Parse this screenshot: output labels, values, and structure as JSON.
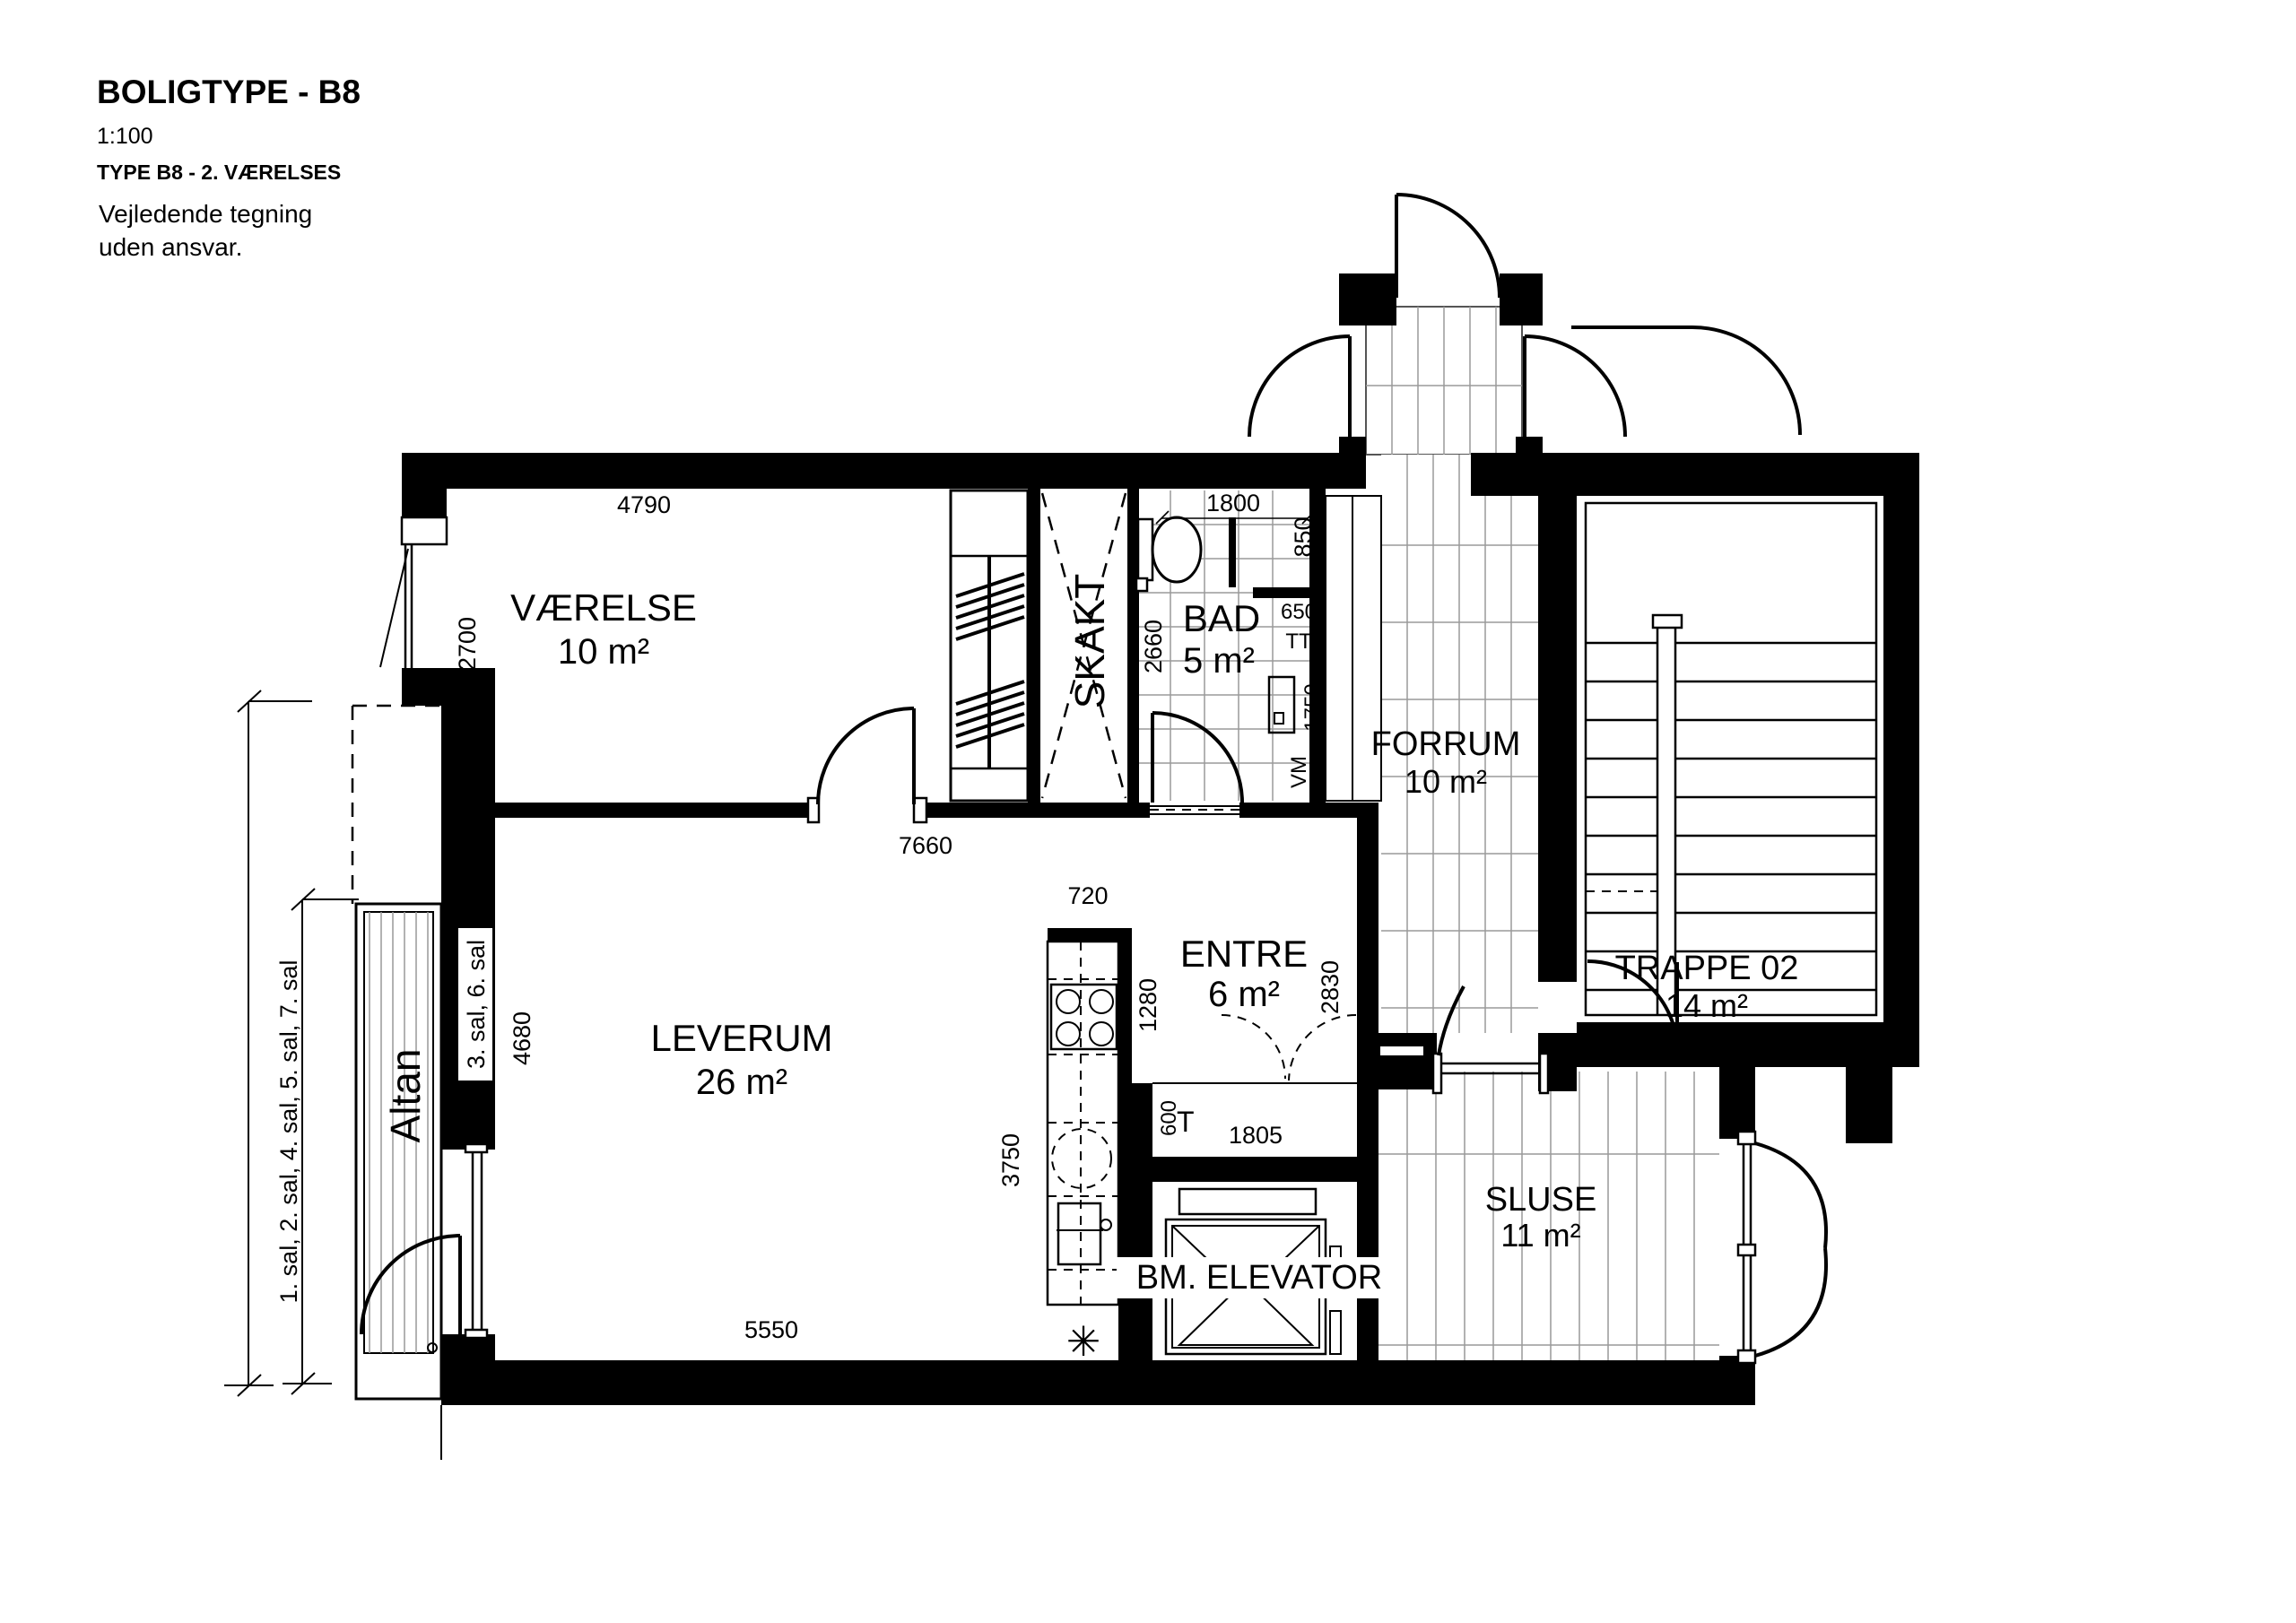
{
  "title_block": {
    "title": "BOLIGTYPE - B8",
    "scale": "1:100",
    "subtitle": "TYPE B8 - 2. VÆRELSES",
    "note_line1": "Vejledende tegning",
    "note_line2": "uden ansvar."
  },
  "rooms": {
    "vaerelse": {
      "name": "VÆRELSE",
      "area": "10 m²"
    },
    "leverum": {
      "name": "LEVERUM",
      "area": "26 m²"
    },
    "entre": {
      "name": "ENTRE",
      "area": "6 m²"
    },
    "bad": {
      "name": "BAD",
      "area": "5 m²"
    },
    "forrum": {
      "name": "FORRUM",
      "area": "10 m²"
    },
    "trappe": {
      "name": "TRAPPE 02",
      "area": "14 m²"
    },
    "sluse": {
      "name": "SLUSE",
      "area": "11 m²"
    },
    "skakt": {
      "name": "SKAKT"
    },
    "elevator": {
      "name": "BM. ELEVATOR"
    },
    "altan": {
      "name": "Altan"
    }
  },
  "dimensions": {
    "vaerelse_width": "4790",
    "bad_width": "1800",
    "shower_width": "850",
    "vaerelse_depth": "2700",
    "bad_depth": "2660",
    "dryer_width": "650",
    "dryer_label": "TT",
    "washer_height": "1750",
    "washer_label": "VM",
    "partition_length": "7660",
    "kitchen_top": "720",
    "kitchen_upper": "1280",
    "entre_depth": "2830",
    "niche_depth": "600",
    "niche_label": "T",
    "niche_width": "1805",
    "leverum_depth": "4680",
    "kitchen_run": "3750",
    "leverum_width": "5550",
    "floor_drain": "✳"
  },
  "floor_labels": {
    "line1": "1. sal, 2. sal, 4. sal, 5. sal, 7. sal",
    "line2": "3. sal, 6. sal"
  },
  "colors": {
    "wall": "#000000",
    "tile_line": "#9a9a9a",
    "background": "#ffffff"
  }
}
